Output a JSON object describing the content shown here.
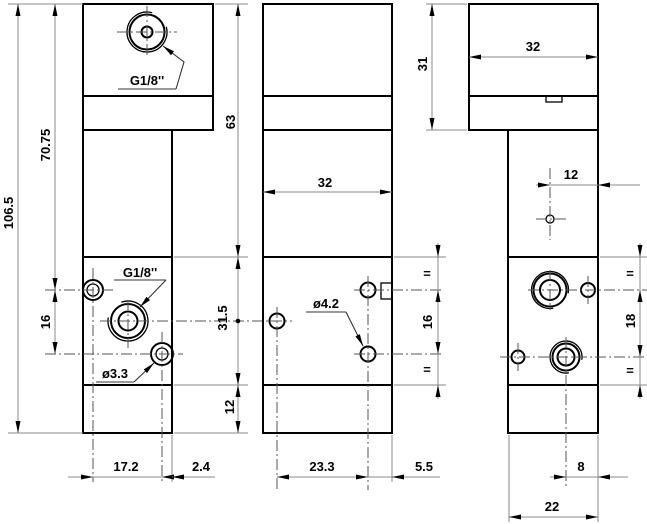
{
  "labels": {
    "port_top": "G1/8''",
    "port_side": "G1/8''",
    "hole_small": "ø3.3",
    "hole_mid": "ø4.2"
  },
  "dims": {
    "total_height": "106.5",
    "upper_height": "70.75",
    "left_hole_spacing": "16",
    "left_hole_x": "17.2",
    "left_hole_edge": "2.4",
    "top_section": "63",
    "port_section": "31.5",
    "foot": "12",
    "front_width": "32",
    "front_hole_spacing_x": "23.3",
    "front_hole_edge": "5.5",
    "front_hole_spacing_y": "16",
    "front_eq_top": "=",
    "front_eq_bottom": "=",
    "side_head_height": "31",
    "side_head_width": "32",
    "side_hole_offset": "12",
    "side_hole_spacing_y": "18",
    "side_eq_top": "=",
    "side_eq_bottom": "=",
    "side_hole2_offset": "8",
    "side_width": "22"
  }
}
